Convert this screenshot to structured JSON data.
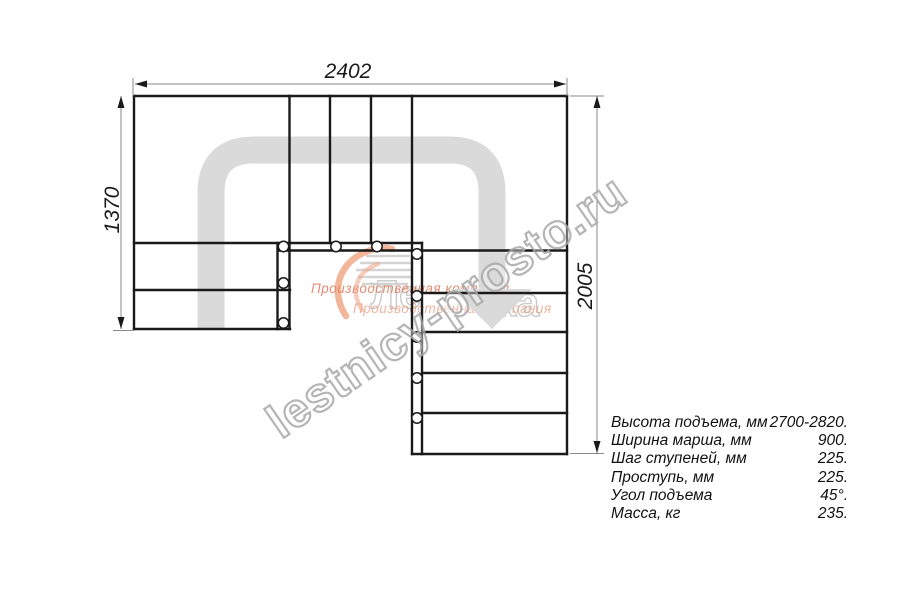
{
  "drawing": {
    "type": "stair-plan-top-view",
    "dimensions": {
      "top_width_mm": "2402",
      "left_height_mm": "1370",
      "right_height_mm": "2005"
    },
    "plan": {
      "left_flight_treads": 2,
      "top_winder_steps": 3,
      "right_flight_treads": 5,
      "baluster_count": 10
    },
    "colors": {
      "outline": "#1a1a1a",
      "dimension_line": "#8a8a8a",
      "direction_arrow": "#dadada",
      "logo_orange": "#ec8658"
    }
  },
  "specs": {
    "rows": [
      {
        "label": "Высота подъема, мм",
        "value": "2700-2820."
      },
      {
        "label": "Ширина марша, мм",
        "value": "900."
      },
      {
        "label": "Шаг ступеней, мм",
        "value": "225."
      },
      {
        "label": "Проступь, мм",
        "value": "225."
      },
      {
        "label": "Угол подъема",
        "value": "45°."
      },
      {
        "label": "Масса, кг",
        "value": "235."
      }
    ]
  },
  "watermark": {
    "site_text": "lestnicy-prosto.ru",
    "company_text": "Производственная компания",
    "logo_fragments": [
      "Ле",
      "ка"
    ]
  }
}
